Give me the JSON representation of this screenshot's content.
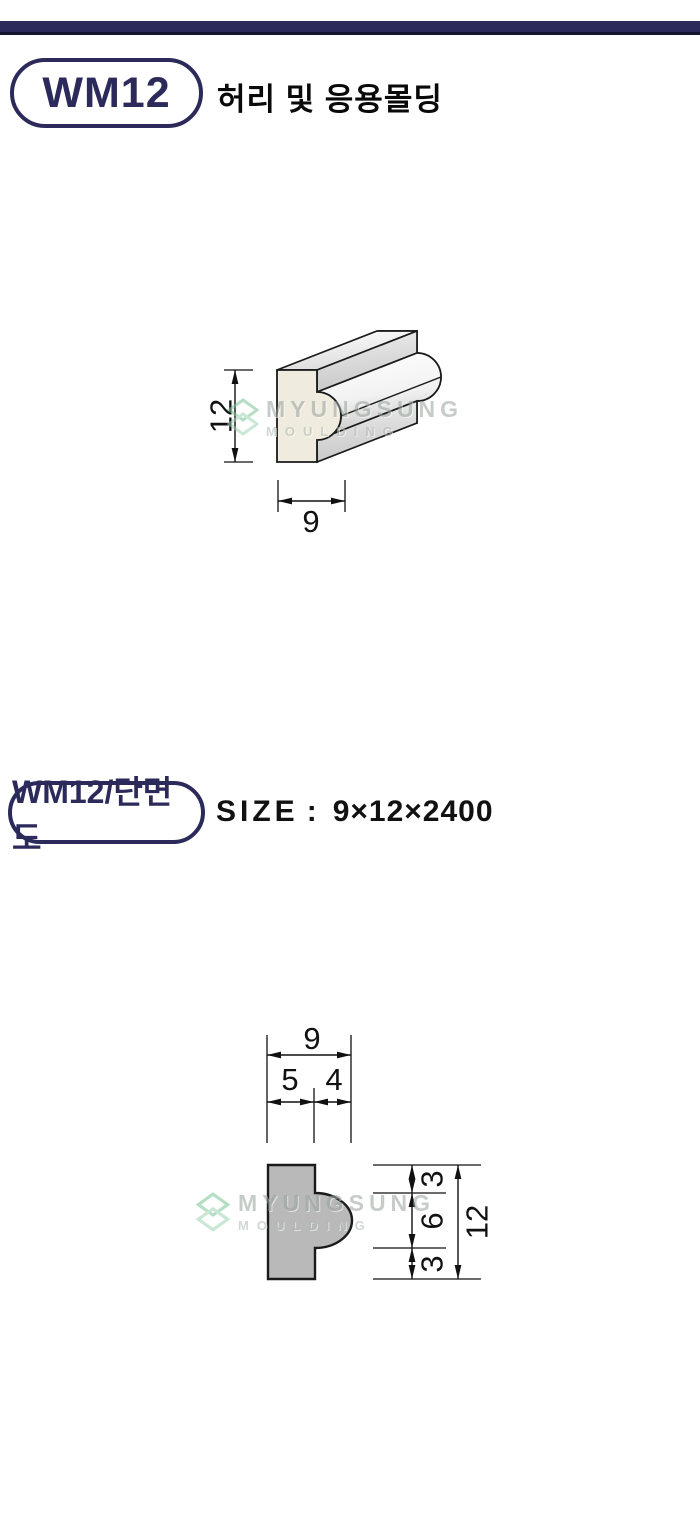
{
  "colors": {
    "navy": "#2b2a5a",
    "bar_edge": "#16162f",
    "drawing_line": "#1a1a1a",
    "section_fill": "#b9b9b9",
    "iso_face_fill": "#f0ebdf",
    "watermark_green": "#7cc494",
    "watermark_gray": "#99a49c"
  },
  "header": {
    "badge": "WM12",
    "title": "허리 및 응용몰딩"
  },
  "iso_view": {
    "dim_height": "12",
    "dim_width": "9"
  },
  "section_view": {
    "badge": "WM12/단면도",
    "size_label": "SIZE",
    "size_colon": ":",
    "size_value": "9×12×2400",
    "dim_overall_width": "9",
    "dim_left_width": "5",
    "dim_bump_depth": "4",
    "dim_top": "3",
    "dim_middle": "6",
    "dim_bottom": "3",
    "dim_overall_height": "12"
  },
  "watermark": {
    "name": "MYUNGSUNG",
    "sub": "MOULDING"
  }
}
